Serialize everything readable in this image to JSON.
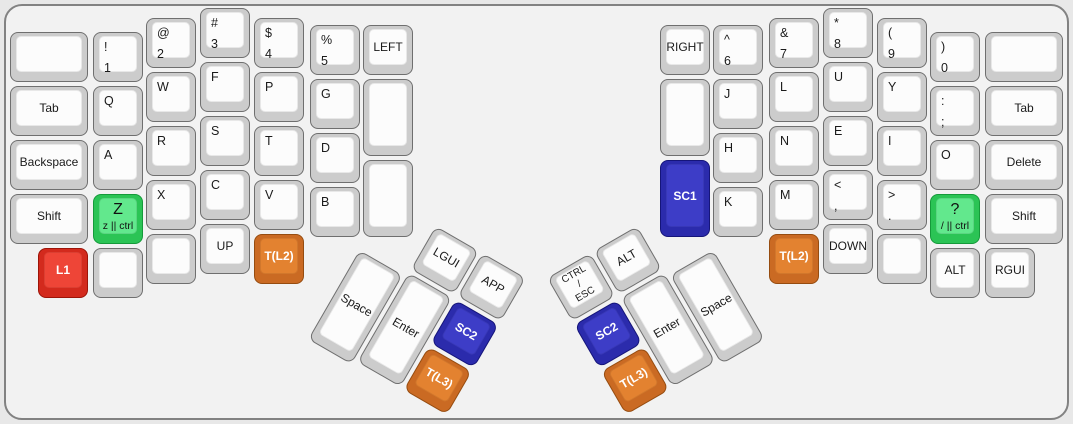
{
  "keyboard": {
    "name": "split-ergo-keyboard-layout",
    "canvas": {
      "background": "#e8e8e8",
      "surface": "#f2f2f2",
      "frame_border": "#828282"
    },
    "key_colors": {
      "default": {
        "outer": "#cccccc",
        "inner": "#fcfcfc",
        "text": "#1a1a1a"
      },
      "green": {
        "outer": "#2bc455",
        "inner": "#62e88d",
        "text": "#111111"
      },
      "red": {
        "outer": "#d32a1d",
        "inner": "#ee4537",
        "text": "#ffffff"
      },
      "blue": {
        "outer": "#2b2bac",
        "inner": "#3d3dc7",
        "text": "#ffffff"
      },
      "orange": {
        "outer": "#ca6a23",
        "inner": "#e38230",
        "text": "#ffffff"
      }
    },
    "groups": [
      {
        "name": "left-main",
        "x": 0,
        "y": 0,
        "rotate": 0,
        "keys": [
          {
            "id": "blank-top-left",
            "x": 10,
            "y": 32,
            "w": 78,
            "labels": []
          },
          {
            "id": "tab-left",
            "x": 10,
            "y": 86,
            "w": 78,
            "labels": [
              "Tab"
            ]
          },
          {
            "id": "backspace",
            "x": 10,
            "y": 140,
            "w": 78,
            "labels": [
              "Backspace"
            ]
          },
          {
            "id": "shift-left",
            "x": 10,
            "y": 194,
            "w": 78,
            "labels": [
              "Shift"
            ]
          },
          {
            "id": "l1",
            "x": 38,
            "y": 248,
            "color": "red",
            "labels": [
              "L1"
            ]
          },
          {
            "id": "num-1",
            "x": 93,
            "y": 32,
            "style": "tl",
            "labels": [
              "!",
              "1"
            ]
          },
          {
            "id": "q",
            "x": 93,
            "y": 86,
            "style": "tl",
            "labels": [
              "Q"
            ]
          },
          {
            "id": "a",
            "x": 93,
            "y": 140,
            "style": "tl",
            "labels": [
              "A"
            ]
          },
          {
            "id": "z",
            "x": 93,
            "y": 194,
            "color": "green",
            "style": "bigsub",
            "labels": [
              "Z",
              "z || ctrl"
            ]
          },
          {
            "id": "blank-left-col1",
            "x": 93,
            "y": 248,
            "labels": []
          },
          {
            "id": "num-2",
            "x": 146,
            "y": 18,
            "style": "tl",
            "labels": [
              "@",
              "2"
            ]
          },
          {
            "id": "w",
            "x": 146,
            "y": 72,
            "style": "tl",
            "labels": [
              "W"
            ]
          },
          {
            "id": "r",
            "x": 146,
            "y": 126,
            "style": "tl",
            "labels": [
              "R"
            ]
          },
          {
            "id": "x",
            "x": 146,
            "y": 180,
            "style": "tl",
            "labels": [
              "X"
            ]
          },
          {
            "id": "blank-left-col2",
            "x": 146,
            "y": 234,
            "labels": []
          },
          {
            "id": "num-3",
            "x": 200,
            "y": 8,
            "style": "tl",
            "labels": [
              "#",
              "3"
            ]
          },
          {
            "id": "f",
            "x": 200,
            "y": 62,
            "style": "tl",
            "labels": [
              "F"
            ]
          },
          {
            "id": "s",
            "x": 200,
            "y": 116,
            "style": "tl",
            "labels": [
              "S"
            ]
          },
          {
            "id": "c",
            "x": 200,
            "y": 170,
            "style": "tl",
            "labels": [
              "C"
            ]
          },
          {
            "id": "up",
            "x": 200,
            "y": 224,
            "labels": [
              "UP"
            ]
          },
          {
            "id": "num-4",
            "x": 254,
            "y": 18,
            "style": "tl",
            "labels": [
              "$",
              "4"
            ]
          },
          {
            "id": "p",
            "x": 254,
            "y": 72,
            "style": "tl",
            "labels": [
              "P"
            ]
          },
          {
            "id": "t",
            "x": 254,
            "y": 126,
            "style": "tl",
            "labels": [
              "T"
            ]
          },
          {
            "id": "v",
            "x": 254,
            "y": 180,
            "style": "tl",
            "labels": [
              "V"
            ]
          },
          {
            "id": "t-l2-left",
            "x": 254,
            "y": 234,
            "color": "orange",
            "labels": [
              "T(L2)"
            ]
          },
          {
            "id": "num-5",
            "x": 310,
            "y": 25,
            "style": "tl",
            "labels": [
              "%",
              "5"
            ]
          },
          {
            "id": "g",
            "x": 310,
            "y": 79,
            "style": "tl",
            "labels": [
              "G"
            ]
          },
          {
            "id": "d",
            "x": 310,
            "y": 133,
            "style": "tl",
            "labels": [
              "D"
            ]
          },
          {
            "id": "b",
            "x": 310,
            "y": 187,
            "style": "tl",
            "labels": [
              "B"
            ]
          },
          {
            "id": "left-key",
            "x": 363,
            "y": 25,
            "labels": [
              "LEFT"
            ]
          },
          {
            "id": "blank-left-inner1",
            "x": 363,
            "y": 79,
            "h": 77,
            "labels": []
          },
          {
            "id": "blank-left-inner2",
            "x": 363,
            "y": 160,
            "h": 77,
            "labels": []
          }
        ]
      },
      {
        "name": "left-thumb",
        "x": 389,
        "y": 198.5,
        "rotate": 30,
        "keys": [
          {
            "id": "space-left",
            "x": 0,
            "y": 59,
            "h": 103,
            "labels": [
              "Space"
            ]
          },
          {
            "id": "lgui",
            "x": 54,
            "y": 0,
            "labels": [
              "LGUI"
            ]
          },
          {
            "id": "enter-left",
            "x": 54,
            "y": 54,
            "h": 103,
            "labels": [
              "Enter"
            ]
          },
          {
            "id": "app",
            "x": 108,
            "y": 0,
            "labels": [
              "APP"
            ]
          },
          {
            "id": "sc2-left",
            "x": 108,
            "y": 54,
            "color": "blue",
            "labels": [
              "SC2"
            ]
          },
          {
            "id": "t-l3-left",
            "x": 108,
            "y": 108,
            "color": "orange",
            "labels": [
              "T(L3)"
            ]
          }
        ]
      },
      {
        "name": "right-main",
        "x": 0,
        "y": 0,
        "rotate": 0,
        "keys": [
          {
            "id": "right-key",
            "x": 660,
            "y": 25,
            "labels": [
              "RIGHT"
            ]
          },
          {
            "id": "blank-right-inner",
            "x": 660,
            "y": 79,
            "h": 77,
            "labels": []
          },
          {
            "id": "sc1",
            "x": 660,
            "y": 160,
            "h": 77,
            "color": "blue",
            "labels": [
              "SC1"
            ]
          },
          {
            "id": "num-6",
            "x": 713,
            "y": 25,
            "style": "tl",
            "labels": [
              "^",
              "6"
            ]
          },
          {
            "id": "j",
            "x": 713,
            "y": 79,
            "style": "tl",
            "labels": [
              "J"
            ]
          },
          {
            "id": "h",
            "x": 713,
            "y": 133,
            "style": "tl",
            "labels": [
              "H"
            ]
          },
          {
            "id": "k",
            "x": 713,
            "y": 187,
            "style": "tl",
            "labels": [
              "K"
            ]
          },
          {
            "id": "num-7",
            "x": 769,
            "y": 18,
            "style": "tl",
            "labels": [
              "&",
              "7"
            ]
          },
          {
            "id": "l",
            "x": 769,
            "y": 72,
            "style": "tl",
            "labels": [
              "L"
            ]
          },
          {
            "id": "n",
            "x": 769,
            "y": 126,
            "style": "tl",
            "labels": [
              "N"
            ]
          },
          {
            "id": "m",
            "x": 769,
            "y": 180,
            "style": "tl",
            "labels": [
              "M"
            ]
          },
          {
            "id": "t-l2-right",
            "x": 769,
            "y": 234,
            "color": "orange",
            "labels": [
              "T(L2)"
            ]
          },
          {
            "id": "num-8",
            "x": 823,
            "y": 8,
            "style": "tl",
            "labels": [
              "*",
              "8"
            ]
          },
          {
            "id": "u",
            "x": 823,
            "y": 62,
            "style": "tl",
            "labels": [
              "U"
            ]
          },
          {
            "id": "e",
            "x": 823,
            "y": 116,
            "style": "tl",
            "labels": [
              "E"
            ]
          },
          {
            "id": "comma",
            "x": 823,
            "y": 170,
            "style": "tl",
            "labels": [
              "<",
              ","
            ]
          },
          {
            "id": "down",
            "x": 823,
            "y": 224,
            "labels": [
              "DOWN"
            ]
          },
          {
            "id": "num-9",
            "x": 877,
            "y": 18,
            "style": "tl",
            "labels": [
              "(",
              "9"
            ]
          },
          {
            "id": "y",
            "x": 877,
            "y": 72,
            "style": "tl",
            "labels": [
              "Y"
            ]
          },
          {
            "id": "i",
            "x": 877,
            "y": 126,
            "style": "tl",
            "labels": [
              "I"
            ]
          },
          {
            "id": "period",
            "x": 877,
            "y": 180,
            "style": "tl",
            "labels": [
              ">",
              "."
            ]
          },
          {
            "id": "blank-right-col4",
            "x": 877,
            "y": 234,
            "labels": []
          },
          {
            "id": "num-0",
            "x": 930,
            "y": 32,
            "style": "tl",
            "labels": [
              ")",
              "0"
            ]
          },
          {
            "id": "semicolon",
            "x": 930,
            "y": 86,
            "style": "tl",
            "labels": [
              ":",
              ";"
            ]
          },
          {
            "id": "o",
            "x": 930,
            "y": 140,
            "style": "tl",
            "labels": [
              "O"
            ]
          },
          {
            "id": "question",
            "x": 930,
            "y": 194,
            "color": "green",
            "style": "bigsub",
            "labels": [
              "?",
              "/ || ctrl"
            ]
          },
          {
            "id": "alt-right",
            "x": 930,
            "y": 248,
            "labels": [
              "ALT"
            ]
          },
          {
            "id": "blank-top-right",
            "x": 985,
            "y": 32,
            "w": 78,
            "labels": []
          },
          {
            "id": "tab-right",
            "x": 985,
            "y": 86,
            "w": 78,
            "labels": [
              "Tab"
            ]
          },
          {
            "id": "delete",
            "x": 985,
            "y": 140,
            "w": 78,
            "labels": [
              "Delete"
            ]
          },
          {
            "id": "shift-right",
            "x": 985,
            "y": 194,
            "w": 78,
            "labels": [
              "Shift"
            ]
          },
          {
            "id": "rgui",
            "x": 985,
            "y": 248,
            "labels": [
              "RGUI"
            ]
          }
        ]
      },
      {
        "name": "right-thumb",
        "x": 547.2,
        "y": 277.5,
        "rotate": -30,
        "keys": [
          {
            "id": "ctrl-esc",
            "x": 0,
            "y": 0,
            "style": "stack",
            "labels": [
              "CTRL",
              "/",
              "ESC"
            ]
          },
          {
            "id": "alt-thumb",
            "x": 54,
            "y": 0,
            "labels": [
              "ALT"
            ]
          },
          {
            "id": "sc2-right",
            "x": 0,
            "y": 54,
            "color": "blue",
            "labels": [
              "SC2"
            ]
          },
          {
            "id": "t-l3-right",
            "x": 0,
            "y": 108,
            "color": "orange",
            "labels": [
              "T(L3)"
            ]
          },
          {
            "id": "enter-right",
            "x": 54,
            "y": 54,
            "h": 103,
            "labels": [
              "Enter"
            ]
          },
          {
            "id": "space-right",
            "x": 108,
            "y": 59,
            "h": 103,
            "labels": [
              "Space"
            ]
          }
        ]
      }
    ]
  }
}
